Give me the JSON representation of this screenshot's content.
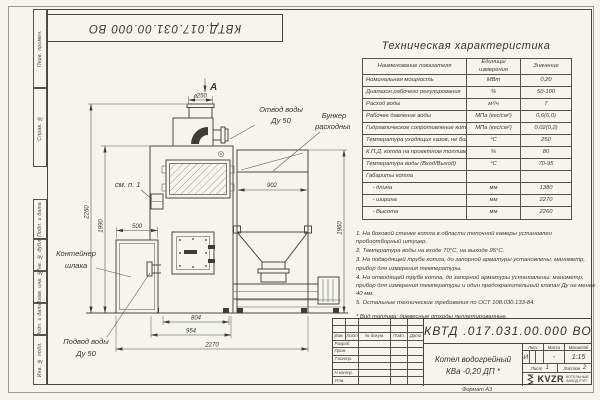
{
  "frame": {
    "doc_number_inverted": "КВТД.017.031.00.000  ВО",
    "side_labels": [
      "Перв. примен.",
      "Справ. №",
      "Подп. и дата",
      "Инв. № дубл.",
      "Взам. инв. №",
      "Подп. и дата",
      "Инв. № подл."
    ],
    "format_note": "Формат А3"
  },
  "spec_table": {
    "title": "Техническая характеристика",
    "headers": [
      "Наименование показателя",
      "Единицы измерения",
      "Значение"
    ],
    "rows": [
      [
        "Номинальная мощность",
        "МВт",
        "0,20"
      ],
      [
        "Диапазон рабочего регулирования",
        "%",
        "50-100"
      ],
      [
        "Расход воды",
        "м³/ч",
        "7"
      ],
      [
        "Рабочее давление воды",
        "МПа (кгс/см²)",
        "0,6(6,0)"
      ],
      [
        "Гидравлическое сопротивление котла",
        "МПа (кгс/см²)",
        "0,02(0,2)"
      ],
      [
        "Температура уходящих газов, не более",
        "°С",
        "250"
      ],
      [
        "К.П.Д. котла на проектном топливе",
        "%",
        "80"
      ],
      [
        "Температура воды (Вход/Выход)",
        "°С",
        "70-95"
      ],
      [
        "Габариты котла",
        "",
        ""
      ],
      [
        "    - длина",
        "мм",
        "1380"
      ],
      [
        "    - ширина",
        "мм",
        "2270"
      ],
      [
        "    - Высота",
        "мм",
        "2260"
      ]
    ]
  },
  "notes": {
    "items": [
      "1.  На боковой стенке котла в области топочной камеры установлен пробоотборный штуцер.",
      "2.  Температура воды на входе 70°С, на выходе 95°С.",
      "3.  На подводящей трубе котла, до запорной арматуры установлены: манометр, прибор для измерения температуры.",
      "4.  На отводящей трубе котла, до запорной арматуры установлены: манометр, прибор для измерения температуры и один предохранительный клапан Ду не менее 40 мм.",
      "5.  Остальные технические требования по ОСТ 108.030.133-84."
    ],
    "fuel_note": "* Вид топлива: древесные отходы пеллетированные."
  },
  "drawing": {
    "labels": {
      "view_a": "А",
      "see_note": "см. п. 1",
      "outlet_line1": "Отвод воды",
      "outlet_line2": "Ду 50",
      "bunker_line1": "Бункер",
      "bunker_line2": "расходный",
      "slag_line1": "Контейнер",
      "slag_line2": "шлака",
      "inlet_line1": "Подвод воды",
      "inlet_line2": "Ду 50"
    },
    "dims": {
      "dia250": "⌀250",
      "w902": "902",
      "h1960": "1960",
      "h2260": "2260",
      "h1990": "1990",
      "w500": "500",
      "w804": "804",
      "w954": "954",
      "w2270": "2270"
    }
  },
  "title_block": {
    "doc_number": "КВТД .017.031.00.000  ВО",
    "header_cols": [
      "Изм.",
      "Лист",
      "№ докум.",
      "Подп.",
      "Дата"
    ],
    "row_labels": [
      "Разраб.",
      "Пров.",
      "Т.контр.",
      "",
      "Н.контр.",
      "Утв."
    ],
    "name_line1": "Котел водогрейный",
    "name_line2": "КВа -0,20  ДП *",
    "lit_label": "Лит.",
    "mass_label": "Масса",
    "scale_label": "Масштаб",
    "lit_value": "И",
    "mass_value": "-",
    "scale_value": "1:15",
    "sheet_label": "Лист",
    "sheet_num": "1",
    "sheets_label": "Листов",
    "sheets_num": "2",
    "brand": "KVZR",
    "brand_line1": "КОТЕЛЬНЫЙ",
    "brand_line2": "ЗАВОД РЭП"
  }
}
